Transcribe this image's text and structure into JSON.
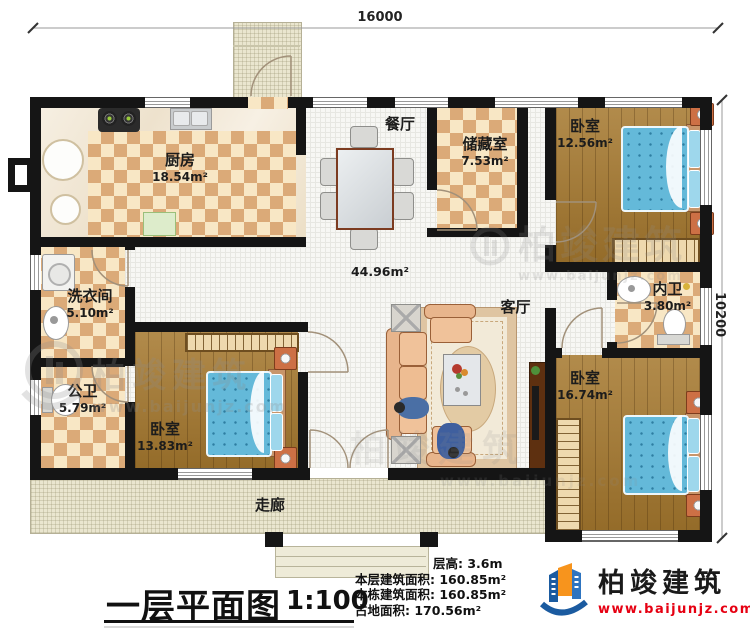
{
  "plan": {
    "dim_top": "16000",
    "dim_right": "10200",
    "hall_area": "44.96m²",
    "rooms": {
      "dining": {
        "name": "餐厅"
      },
      "kitchen": {
        "name": "厨房",
        "area": "18.54m²"
      },
      "storage": {
        "name": "储藏室",
        "area": "7.53m²"
      },
      "bedroom_tr": {
        "name": "卧室",
        "area": "12.56m²"
      },
      "laundry": {
        "name": "洗衣间",
        "area": "5.10m²"
      },
      "public_bath": {
        "name": "公卫",
        "area": "5.79m²"
      },
      "bedroom_bl": {
        "name": "卧室",
        "area": "13.83m²"
      },
      "ensuite": {
        "name": "内卫",
        "area": "3.80m²"
      },
      "bedroom_br": {
        "name": "卧室",
        "area": "16.74m²"
      },
      "living": {
        "name": "客厅"
      },
      "corridor": {
        "name": "走廊"
      }
    }
  },
  "title_block": {
    "title": "一层平面图",
    "scale": "1:100",
    "floor_height": "层高: 3.6m",
    "floor_area": "本层建筑面积: 160.85m²",
    "building_area": "本栋建筑面积: 160.85m²",
    "land_area": "占地面积: 170.56m²"
  },
  "branding": {
    "company": "柏竣建筑",
    "website": "www.baijunjz.com"
  },
  "watermark": {
    "company": "柏竣建筑",
    "website": "www.baijunjz.com"
  },
  "colors": {
    "wall": "#151515",
    "bed_blue": "#64b9d9",
    "tile_tan": "#dbaa78",
    "wood": "#a5782e",
    "website_red": "#e60012"
  }
}
